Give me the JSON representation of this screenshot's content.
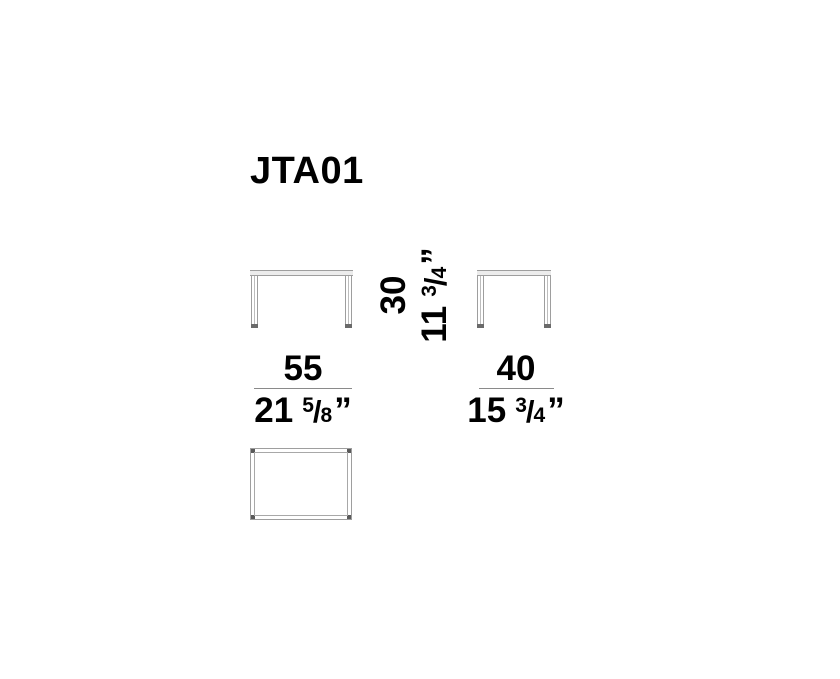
{
  "title": "JTA01",
  "dimensions": {
    "width": {
      "metric": "55",
      "imperial_whole": "21",
      "frac_num": "5",
      "frac_slash": "/",
      "frac_den": "8",
      "unit": "”"
    },
    "depth": {
      "metric": "40",
      "imperial_whole": "15",
      "frac_num": "3",
      "frac_slash": "/",
      "frac_den": "4",
      "unit": "”"
    },
    "height": {
      "metric": "30",
      "imperial_whole": "11",
      "frac_num": "3",
      "frac_slash": "/",
      "frac_den": "4",
      "unit": "”"
    }
  },
  "colors": {
    "background": "#ffffff",
    "text": "#000000",
    "drawing_line": "#9e9e9e",
    "dimension_line": "#8a8a8a",
    "foot_dark": "#6a6a6a"
  }
}
